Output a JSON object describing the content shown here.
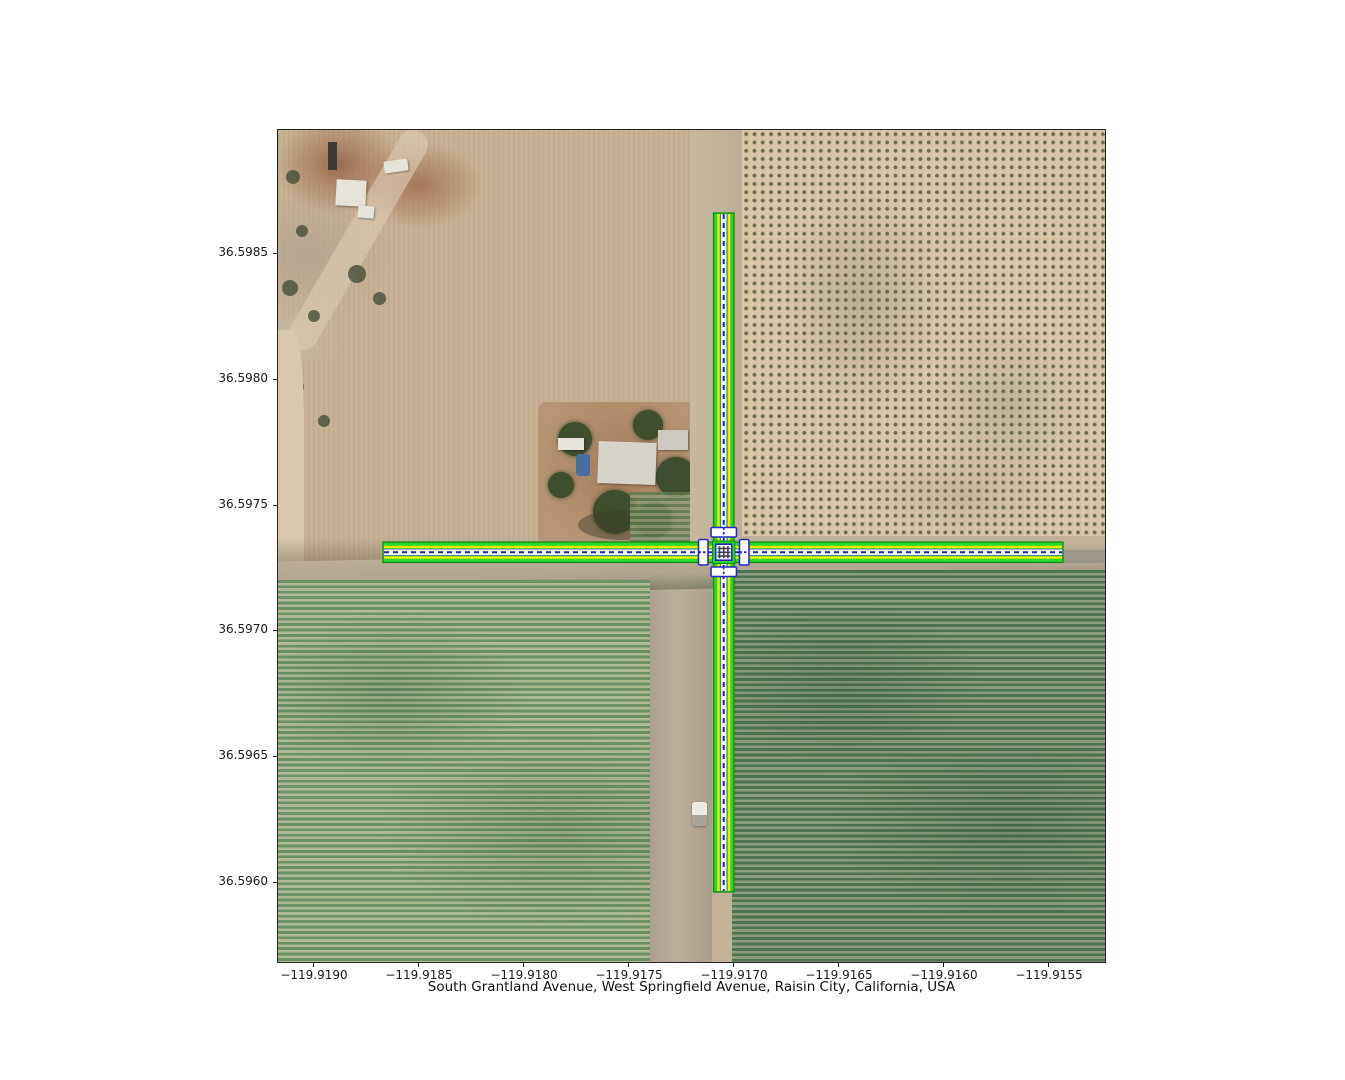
{
  "figure": {
    "xlabel": "South Grantland Avenue, West Springfield Avenue, Raisin City, California, USA",
    "background": "#ffffff"
  },
  "axes": {
    "x_ticks": [
      "−119.9190",
      "−119.9185",
      "−119.9180",
      "−119.9175",
      "−119.9170",
      "−119.9165",
      "−119.9160",
      "−119.9155"
    ],
    "y_ticks": [
      "36.5985",
      "36.5980",
      "36.5975",
      "36.5970",
      "36.5965",
      "36.5960"
    ]
  },
  "map": {
    "location": "Raisin City, California, USA",
    "roads": [
      {
        "name": "South Grantland Avenue",
        "orientation": "vertical"
      },
      {
        "name": "West Springfield Avenue",
        "orientation": "horizontal"
      }
    ],
    "overlay_colors": {
      "road_fill_green": "#2bd42b",
      "road_edge_dark_green": "#0e8a0e",
      "lane_line_yellow": "#eded00",
      "center_band_white": "#f7f7f2",
      "centerline_blue": "#2222c2",
      "crossing_border_blue": "#2a2ac8"
    },
    "terrain_colors": {
      "bare_field_tan": "#c8b295",
      "orchard_base": "#d5c4a4",
      "orchard_tree_dot": "#6b6b51",
      "vineyard_left_dark": "#6c9168",
      "vineyard_left_light": "#afba93",
      "vineyard_right_dark": "#4f7350",
      "vineyard_right_light": "#8c9c7e",
      "dirt_road": "#b3a996"
    }
  }
}
